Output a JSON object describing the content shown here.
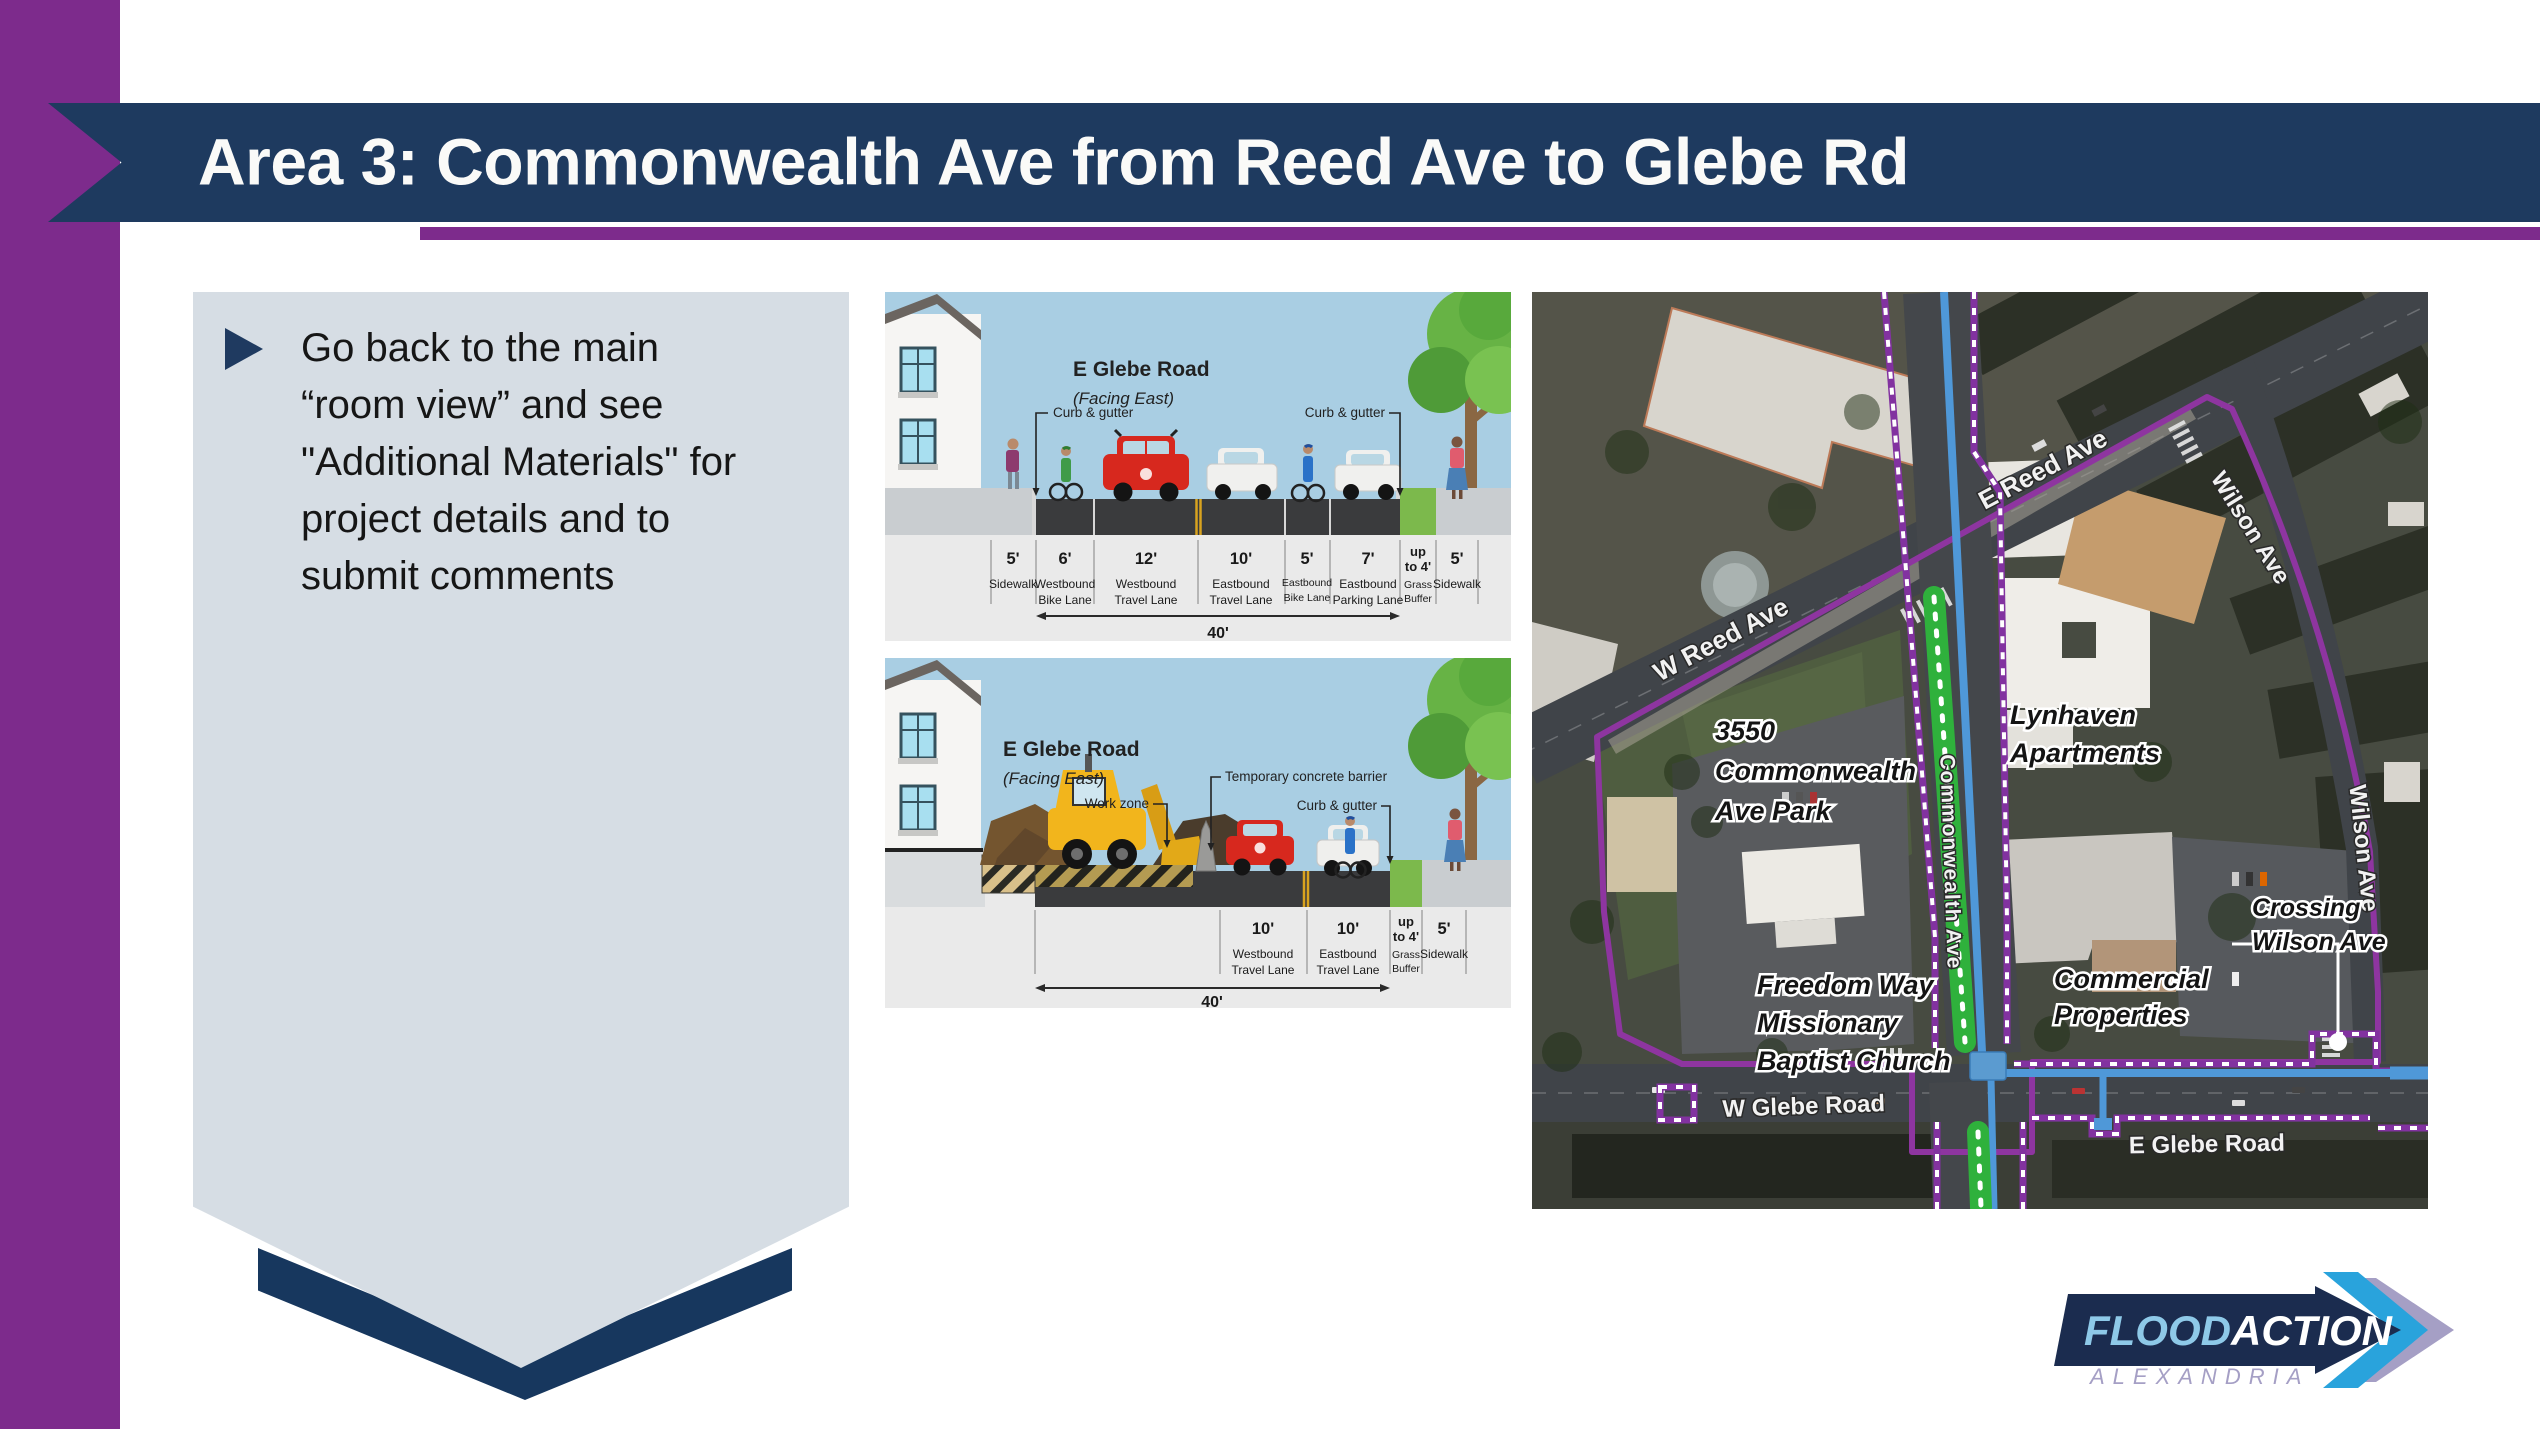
{
  "slide": {
    "title": "Area 3: Commonwealth Ave from Reed Ave to Glebe Rd"
  },
  "panel": {
    "lines": [
      "Go back to the main",
      "“room view” and see",
      "\"Additional Materials\" for",
      "project details and to",
      "submit comments"
    ]
  },
  "diagram_top": {
    "title": "E Glebe Road",
    "subtitle": "(Facing East)",
    "callout_curb_left": "Curb & gutter",
    "callout_curb_right": "Curb & gutter",
    "total": "40'",
    "lanes": [
      {
        "w": "5'",
        "l1": "Sidewalk"
      },
      {
        "w": "6'",
        "l1": "Westbound",
        "l2": "Bike Lane"
      },
      {
        "w": "12'",
        "l1": "Westbound",
        "l2": "Travel Lane"
      },
      {
        "w": "10'",
        "l1": "Eastbound",
        "l2": "Travel Lane"
      },
      {
        "w": "5'",
        "l1": "Eastbound",
        "l2": "Bike Lane"
      },
      {
        "w": "7'",
        "l1": "Eastbound",
        "l2": "Parking Lane"
      },
      {
        "w1": "up",
        "w2": "to 4'",
        "l1": "Grass",
        "l2": "Buffer"
      },
      {
        "w": "5'",
        "l1": "Sidewalk"
      }
    ]
  },
  "diagram_bottom": {
    "title": "E Glebe Road",
    "subtitle": "(Facing East)",
    "callout_work_zone": "Work zone",
    "callout_barrier": "Temporary concrete barrier",
    "callout_curb": "Curb & gutter",
    "total": "40'",
    "lanes": [
      {
        "w": "10'",
        "l1": "Westbound",
        "l2": "Travel Lane"
      },
      {
        "w": "10'",
        "l1": "Eastbound",
        "l2": "Travel Lane"
      },
      {
        "w1": "up",
        "w2": "to 4'",
        "l1": "Grass",
        "l2": "Buffer"
      },
      {
        "w": "5'",
        "l1": "Sidewalk"
      }
    ]
  },
  "map": {
    "roads": {
      "e_reed": "E Reed Ave",
      "w_reed": "W Reed Ave",
      "wilson_upper": "Wilson Ave",
      "wilson_lower": "Wilson Ave",
      "commonwealth": "Commonwealth Ave",
      "w_glebe": "W Glebe Road",
      "e_glebe": "E Glebe Road"
    },
    "places": {
      "park": {
        "l1": "3550",
        "l2": "Commonwealth",
        "l3": "Ave Park"
      },
      "lynhaven": {
        "l1": "Lynhaven",
        "l2": "Apartments"
      },
      "church": {
        "l1": "Freedom Way",
        "l2": "Missionary",
        "l3": "Baptist Church"
      },
      "commercial": {
        "l1": "Commercial",
        "l2": "Properties"
      },
      "crossing": {
        "l1": "Crossing",
        "l2": "Wilson Ave"
      }
    }
  },
  "logo": {
    "flood": "FLOOD",
    "action": "ACTION",
    "city": "ALEXANDRIA"
  },
  "colors": {
    "accent_purple": "#7d2b8c",
    "banner_navy": "#1e3a5f",
    "panel_gray": "#d6dde4",
    "boundary_purple": "#8e35a0",
    "water_blue": "#4f98d8",
    "median_green": "#2fb13c",
    "logo_navy": "#1b2c4f",
    "logo_blue": "#29a3dc",
    "logo_lavender": "#a59fc5"
  }
}
